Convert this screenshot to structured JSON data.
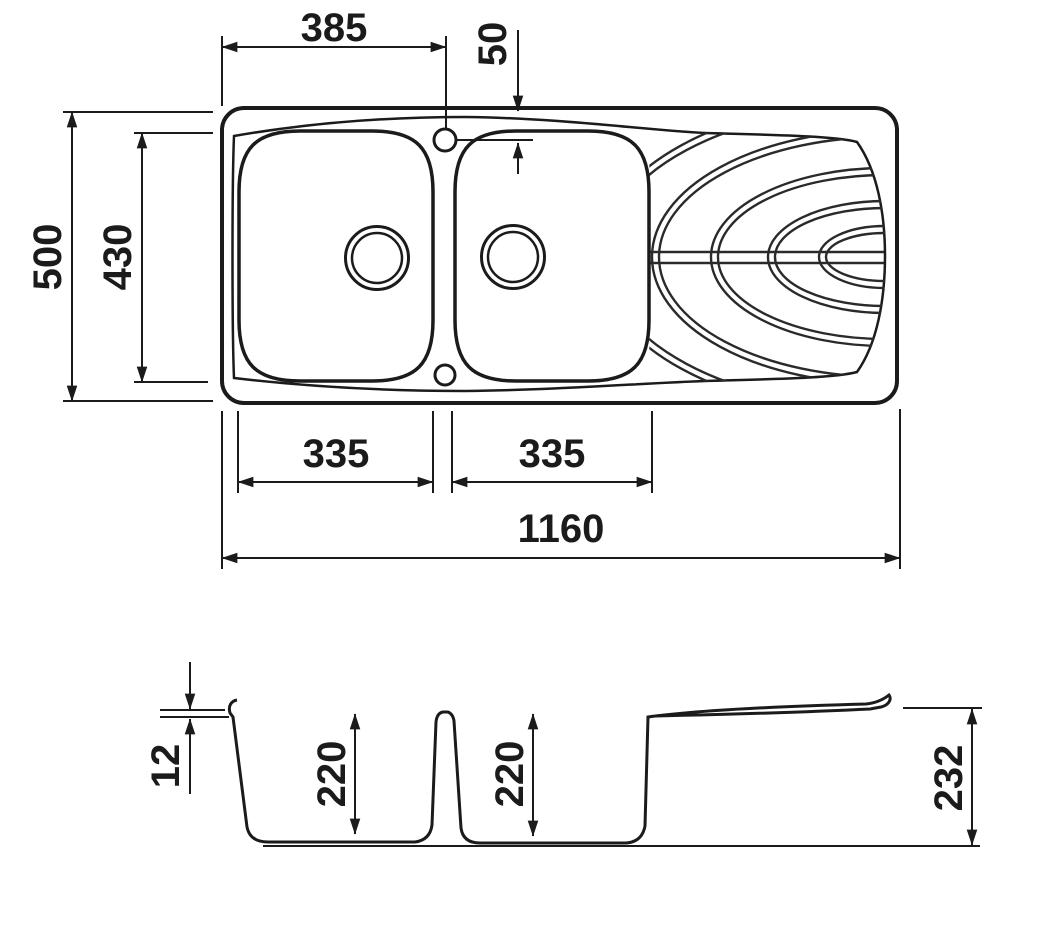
{
  "drawing": {
    "subject": "double-bowl kitchen sink with drainer - dimensioned technical drawing",
    "colors": {
      "line": "#1b1b1b",
      "background": "#ffffff"
    }
  },
  "top_view": {
    "dim_385": "385",
    "dim_50": "50",
    "dim_500": "500",
    "dim_430": "430",
    "dim_335_left": "335",
    "dim_335_right": "335",
    "dim_1160": "1160"
  },
  "section_view": {
    "dim_12": "12",
    "dim_220_left": "220",
    "dim_220_right": "220",
    "dim_232": "232"
  }
}
